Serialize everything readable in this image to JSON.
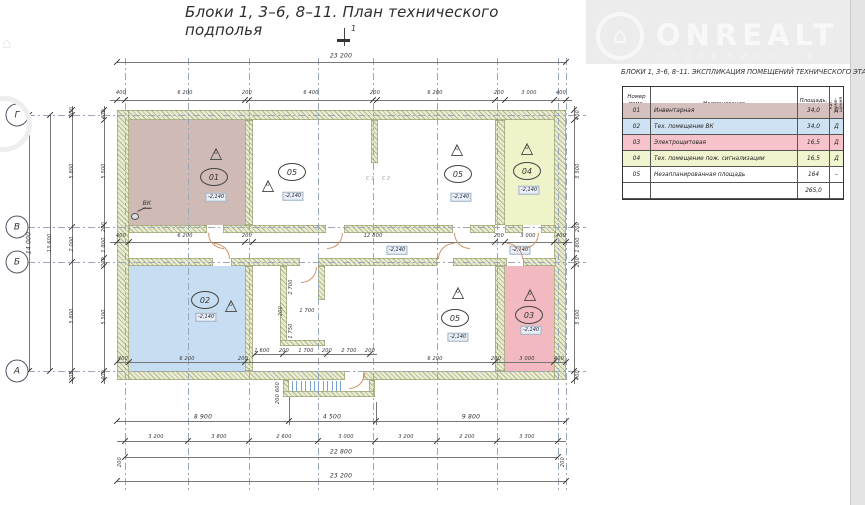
{
  "title": "Блоки 1,  3–6, 8–11.    План технического подполья",
  "section_mark": "1",
  "watermark": {
    "brand": "ONREALT",
    "subtitle": "НЕДВИЖИМОСТЬ",
    "house_icon": "⌂"
  },
  "table": {
    "title": "БЛОКИ 1,  3–6, 8–11.  ЭКСПЛИКАЦИЯ ПОМЕЩЕНИЙ ТЕХНИЧЕСКОГО ЭТАЖА",
    "headers": {
      "num": "Номер поме- щения",
      "name": "Наименование",
      "area": "Площадь, м²",
      "cat": "Кат. поме- щения"
    },
    "rows": [
      {
        "num": "01",
        "name": "Инвентарная",
        "area": "34,0",
        "cat": "Д",
        "color": "#d6c0bd"
      },
      {
        "num": "02",
        "name": "Тех. помещение ВК",
        "area": "34,0",
        "cat": "Д",
        "color": "#cfe2f3"
      },
      {
        "num": "03",
        "name": "Электрощитовая",
        "area": "16,5",
        "cat": "Д",
        "color": "#f5c3c9"
      },
      {
        "num": "04",
        "name": "Тех. помещение пож. сигнализации",
        "area": "16,5",
        "cat": "Д",
        "color": "#f1f5cf"
      },
      {
        "num": "05",
        "name": "Незапланированная площадь",
        "area": "164",
        "cat": "–",
        "color": "#ffffff"
      }
    ],
    "total": "265,0"
  },
  "plan": {
    "accent_colors": {
      "room01": "#d0bab6",
      "room02": "#c7ddf1",
      "room03": "#f2bac0",
      "room04": "#eef3c9",
      "wall_hatch": "#8f9565",
      "door_arc": "#cf9466",
      "stair_tread": "#7aa3d4"
    },
    "fills": [
      [
        129,
        120,
        116,
        105,
        "#d0bab6"
      ],
      [
        129,
        266,
        116,
        105,
        "#c7ddf1"
      ],
      [
        505,
        120,
        49,
        105,
        "#eef3c9"
      ],
      [
        505,
        266,
        49,
        105,
        "#f2bac0"
      ]
    ],
    "walls": [
      [
        117,
        110,
        449,
        10
      ],
      [
        117,
        371,
        228,
        9
      ],
      [
        363,
        371,
        203,
        9
      ],
      [
        117,
        110,
        12,
        270
      ],
      [
        554,
        110,
        12,
        270
      ],
      [
        245,
        120,
        8,
        105
      ],
      [
        245,
        266,
        8,
        105
      ],
      [
        495,
        120,
        10,
        105
      ],
      [
        495,
        266,
        10,
        105
      ],
      [
        129,
        225,
        78,
        8
      ],
      [
        223,
        225,
        103,
        8
      ],
      [
        344,
        225,
        109,
        8
      ],
      [
        470,
        225,
        25,
        8
      ],
      [
        505,
        225,
        18,
        8
      ],
      [
        541,
        225,
        15,
        8
      ],
      [
        129,
        258,
        84,
        8
      ],
      [
        231,
        258,
        69,
        8
      ],
      [
        318,
        258,
        119,
        8
      ],
      [
        453,
        258,
        54,
        8
      ],
      [
        523,
        258,
        33,
        8
      ],
      [
        371,
        120,
        7,
        43
      ],
      [
        280,
        266,
        7,
        80
      ],
      [
        318,
        266,
        7,
        34
      ],
      [
        280,
        340,
        45,
        6
      ],
      [
        283,
        380,
        6,
        17
      ],
      [
        369,
        380,
        6,
        17
      ],
      [
        283,
        391,
        92,
        6
      ]
    ],
    "gridv": [
      [
        125,
        58,
        434
      ],
      [
        188,
        58,
        434
      ],
      [
        249,
        58,
        434
      ],
      [
        318,
        58,
        434
      ],
      [
        373,
        58,
        434
      ],
      [
        437,
        58,
        434
      ],
      [
        497,
        58,
        434
      ],
      [
        558,
        58,
        434
      ],
      [
        566,
        58,
        434
      ]
    ],
    "gridh": [
      [
        28,
        115,
        558
      ],
      [
        28,
        227,
        558
      ],
      [
        28,
        262,
        558
      ],
      [
        28,
        371,
        558
      ]
    ],
    "dlh": [
      [
        117,
        62,
        449
      ],
      [
        110,
        100,
        462
      ],
      [
        110,
        242,
        462
      ],
      [
        255,
        354,
        122
      ],
      [
        117,
        362,
        449
      ],
      [
        117,
        421,
        449
      ],
      [
        117,
        441,
        449
      ],
      [
        125,
        457,
        433
      ],
      [
        117,
        481,
        449
      ]
    ],
    "dlv": [
      [
        29,
        115,
        256
      ],
      [
        50,
        115,
        256
      ],
      [
        72,
        106,
        278
      ],
      [
        104,
        106,
        278
      ],
      [
        574,
        106,
        278
      ],
      [
        289,
        397,
        28
      ],
      [
        376,
        402,
        23
      ]
    ],
    "ticks": [
      [
        117,
        62
      ],
      [
        566,
        62
      ],
      [
        117,
        100
      ],
      [
        125,
        100
      ],
      [
        245,
        100
      ],
      [
        249,
        100
      ],
      [
        373,
        100
      ],
      [
        377,
        100
      ],
      [
        495,
        100
      ],
      [
        505,
        100
      ],
      [
        554,
        100
      ],
      [
        566,
        100
      ],
      [
        117,
        242
      ],
      [
        129,
        242
      ],
      [
        245,
        242
      ],
      [
        253,
        242
      ],
      [
        495,
        242
      ],
      [
        505,
        242
      ],
      [
        554,
        242
      ],
      [
        566,
        242
      ],
      [
        255,
        354
      ],
      [
        283,
        354
      ],
      [
        327,
        354
      ],
      [
        370,
        354
      ],
      [
        117,
        362
      ],
      [
        129,
        362
      ],
      [
        245,
        362
      ],
      [
        495,
        362
      ],
      [
        554,
        362
      ],
      [
        566,
        362
      ],
      [
        117,
        421
      ],
      [
        289,
        421
      ],
      [
        376,
        421
      ],
      [
        566,
        421
      ],
      [
        125,
        441
      ],
      [
        188,
        441
      ],
      [
        249,
        441
      ],
      [
        318,
        441
      ],
      [
        375,
        441
      ],
      [
        437,
        441
      ],
      [
        497,
        441
      ],
      [
        558,
        441
      ],
      [
        125,
        457
      ],
      [
        558,
        457
      ],
      [
        117,
        481
      ],
      [
        566,
        481
      ],
      [
        29,
        115
      ],
      [
        29,
        371
      ],
      [
        50,
        115
      ],
      [
        50,
        371
      ],
      [
        72,
        110
      ],
      [
        72,
        115
      ],
      [
        72,
        227
      ],
      [
        72,
        262
      ],
      [
        72,
        371
      ],
      [
        72,
        380
      ],
      [
        104,
        110
      ],
      [
        104,
        120
      ],
      [
        104,
        225
      ],
      [
        104,
        258
      ],
      [
        104,
        266
      ],
      [
        104,
        371
      ],
      [
        104,
        380
      ],
      [
        574,
        110
      ],
      [
        574,
        120
      ],
      [
        574,
        225
      ],
      [
        574,
        258
      ],
      [
        574,
        266
      ],
      [
        574,
        371
      ],
      [
        574,
        380
      ]
    ],
    "labels": [
      [
        "23 200",
        341,
        56,
        0,
        "big"
      ],
      [
        "400",
        121,
        93,
        0
      ],
      [
        "6 200",
        185,
        93,
        0
      ],
      [
        "200",
        247,
        93,
        0
      ],
      [
        "6 400",
        311,
        93,
        0
      ],
      [
        "200",
        375,
        93,
        0
      ],
      [
        "6 200",
        435,
        93,
        0
      ],
      [
        "200",
        499,
        93,
        0
      ],
      [
        "3 000",
        529,
        93,
        0
      ],
      [
        "400",
        561,
        93,
        0
      ],
      [
        "400",
        121,
        236,
        0
      ],
      [
        "6 200",
        185,
        236,
        0
      ],
      [
        "200",
        247,
        236,
        0
      ],
      [
        "12 800",
        373,
        236,
        0
      ],
      [
        "200",
        499,
        236,
        0
      ],
      [
        "3 000",
        528,
        236,
        0
      ],
      [
        "400",
        561,
        236,
        0
      ],
      [
        "1 600",
        262,
        351,
        0
      ],
      [
        "200",
        284,
        351,
        0
      ],
      [
        "1 700",
        306,
        351,
        0
      ],
      [
        "200",
        327,
        351,
        0
      ],
      [
        "2 700",
        349,
        351,
        0
      ],
      [
        "200",
        370,
        351,
        0
      ],
      [
        "400",
        123,
        359,
        0
      ],
      [
        "6 200",
        187,
        359,
        0
      ],
      [
        "200",
        243,
        359,
        0
      ],
      [
        "6 200",
        435,
        359,
        0
      ],
      [
        "200",
        496,
        359,
        0
      ],
      [
        "3 000",
        527,
        359,
        0
      ],
      [
        "400",
        559,
        359,
        0
      ],
      [
        "8 900",
        203,
        417,
        0,
        "big"
      ],
      [
        "4 500",
        332,
        417,
        0,
        "big"
      ],
      [
        "9 800",
        471,
        417,
        0,
        "big"
      ],
      [
        "3 200",
        156,
        437,
        0
      ],
      [
        "3 800",
        219,
        437,
        0
      ],
      [
        "2 600",
        284,
        437,
        0
      ],
      [
        "3 000",
        346,
        437,
        0
      ],
      [
        "3 200",
        406,
        437,
        0
      ],
      [
        "2 200",
        467,
        437,
        0
      ],
      [
        "3 300",
        527,
        437,
        0
      ],
      [
        "22 800",
        341,
        452,
        0,
        "big"
      ],
      [
        "200",
        120,
        462,
        1
      ],
      [
        "200",
        563,
        462,
        1
      ],
      [
        "23 200",
        341,
        476,
        0,
        "big"
      ],
      [
        "14 000",
        29,
        243,
        1,
        "big"
      ],
      [
        "13 600",
        50,
        243,
        1
      ],
      [
        "200",
        72,
        112,
        1
      ],
      [
        "5 800",
        72,
        171,
        1
      ],
      [
        "2 000",
        72,
        244,
        1
      ],
      [
        "5 800",
        72,
        316,
        1
      ],
      [
        "200",
        72,
        376,
        1
      ],
      [
        "400",
        104,
        114,
        1
      ],
      [
        "5 500",
        104,
        171,
        1
      ],
      [
        "200",
        104,
        227,
        1
      ],
      [
        "1 800",
        104,
        245,
        1
      ],
      [
        "200",
        104,
        262,
        1
      ],
      [
        "5 500",
        104,
        317,
        1
      ],
      [
        "400",
        104,
        375,
        1
      ],
      [
        "400",
        578,
        115,
        1
      ],
      [
        "5 500",
        578,
        171,
        1
      ],
      [
        "200",
        578,
        227,
        1
      ],
      [
        "1 800",
        578,
        245,
        1
      ],
      [
        "200",
        578,
        262,
        1
      ],
      [
        "5 500",
        578,
        317,
        1
      ],
      [
        "400",
        578,
        375,
        1
      ],
      [
        "2 700",
        291,
        287,
        1
      ],
      [
        "1 750",
        291,
        331,
        1
      ],
      [
        "200",
        281,
        311,
        1
      ],
      [
        "1 700",
        307,
        311,
        0
      ],
      [
        "600",
        278,
        387,
        1
      ],
      [
        "200",
        278,
        399,
        1
      ],
      [
        "С 3",
        370,
        179,
        0,
        "tinyg"
      ],
      [
        "С 2",
        386,
        179,
        0,
        "tinyg"
      ],
      [
        "ВК",
        147,
        204,
        0,
        "vk"
      ]
    ],
    "bubbles": [
      [
        "Г",
        17,
        115
      ],
      [
        "В",
        17,
        227
      ],
      [
        "Б",
        17,
        262
      ],
      [
        "А",
        17,
        371
      ]
    ],
    "markers": {
      "ellipses": [
        {
          "t": "01",
          "x": 214,
          "y": 177
        },
        {
          "t": "05",
          "x": 292,
          "y": 172
        },
        {
          "t": "05",
          "x": 458,
          "y": 174
        },
        {
          "t": "04",
          "x": 527,
          "y": 171
        },
        {
          "t": "02",
          "x": 205,
          "y": 300
        },
        {
          "t": "05",
          "x": 455,
          "y": 318
        },
        {
          "t": "03",
          "x": 529,
          "y": 315
        }
      ],
      "triangles": [
        {
          "t": "0",
          "x": 216,
          "y": 152
        },
        {
          "t": "0",
          "x": 268,
          "y": 184
        },
        {
          "t": "0",
          "x": 457,
          "y": 148
        },
        {
          "t": "0",
          "x": 527,
          "y": 147
        },
        {
          "t": "0",
          "x": 231,
          "y": 304
        },
        {
          "t": "0",
          "x": 458,
          "y": 291
        },
        {
          "t": "0",
          "x": 530,
          "y": 293
        }
      ],
      "levels": [
        {
          "t": "-2,140",
          "x": 216,
          "y": 197
        },
        {
          "t": "-2,140",
          "x": 293,
          "y": 196
        },
        {
          "t": "-2,140",
          "x": 461,
          "y": 197
        },
        {
          "t": "-2,140",
          "x": 529,
          "y": 190
        },
        {
          "t": "-2,140",
          "x": 206,
          "y": 317
        },
        {
          "t": "-2,140",
          "x": 458,
          "y": 337
        },
        {
          "t": "-2,140",
          "x": 531,
          "y": 330
        },
        {
          "t": "-2,140",
          "x": 397,
          "y": 250
        },
        {
          "t": "-2,140",
          "x": 520,
          "y": 250
        }
      ]
    },
    "arcs": [
      [
        208,
        233,
        "abl"
      ],
      [
        327,
        233,
        "abr"
      ],
      [
        454,
        233,
        "abl"
      ],
      [
        523,
        233,
        "abr"
      ],
      [
        214,
        243,
        "atr"
      ],
      [
        438,
        243,
        "atl"
      ],
      [
        507,
        243,
        "atr"
      ],
      [
        301,
        267,
        "abr"
      ],
      [
        349,
        373,
        "abr"
      ]
    ],
    "treads": {
      "x0": 292,
      "y": 381,
      "h": 10,
      "step": 4.4,
      "count": 12
    }
  }
}
